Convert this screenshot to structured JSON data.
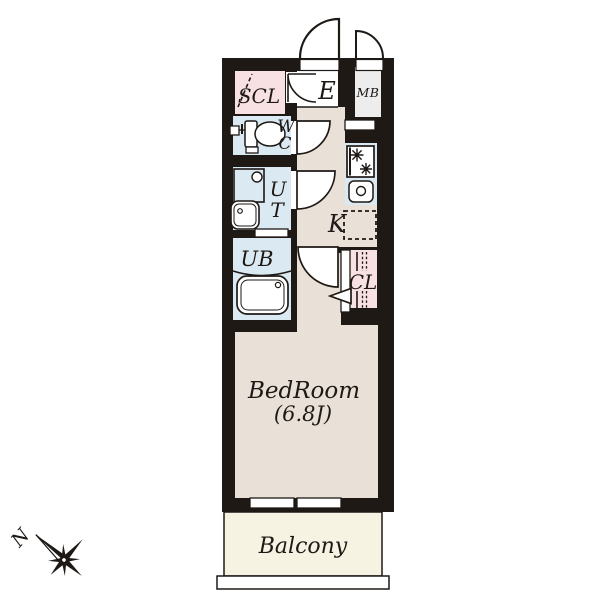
{
  "plan": {
    "type": "apartment-floor-plan",
    "rooms": {
      "scl": {
        "label": "SCL"
      },
      "entrance": {
        "label": "E"
      },
      "meter_box": {
        "label": "MB"
      },
      "wc": {
        "line1": "W",
        "line2": "C"
      },
      "ut": {
        "line1": "U",
        "line2": "T"
      },
      "kitchen": {
        "label": "K"
      },
      "unit_bath": {
        "label": "UB"
      },
      "closet": {
        "label": "CL"
      },
      "bedroom": {
        "label": "BedRoom",
        "size": "(6.8J)"
      },
      "balcony": {
        "label": "Balcony"
      }
    },
    "compass": {
      "label": "N"
    },
    "icons": [
      "toilet-icon",
      "washing-machine-pan-icon",
      "vanity-sink-icon",
      "bathtub-icon",
      "stove-burners-icon",
      "kitchen-sink-icon",
      "fridge-space-dashed-icon",
      "hanger-pipe-icon",
      "door-swing-arc-icon",
      "compass-rose-icon"
    ]
  },
  "colors": {
    "wall": "#1e1915",
    "line": "#1e1915",
    "pink": "#f8e1e3",
    "blue": "#dbe9f2",
    "beige": "#e9e1d8",
    "gray": "#ededed",
    "balcony": "#f6f3e2",
    "white": "#ffffff"
  }
}
